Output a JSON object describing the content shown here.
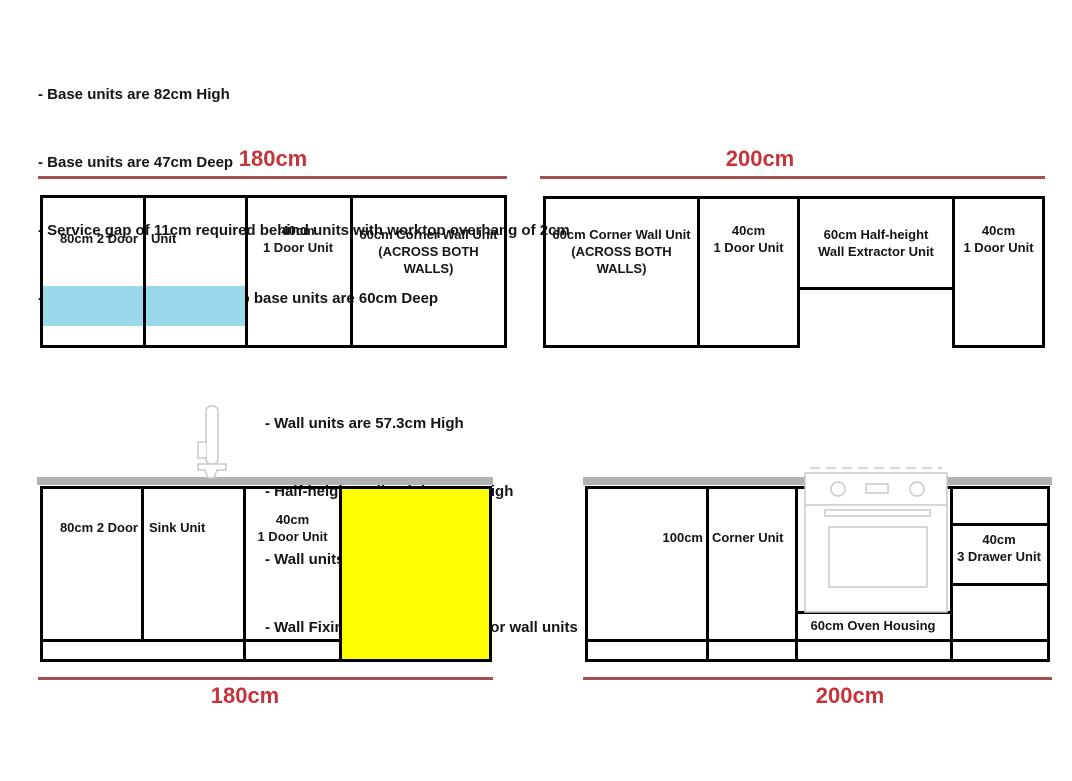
{
  "notes_base": {
    "lines": [
      "- Base units are 82cm High",
      "- Base units are 47cm Deep",
      "- Service gap of 11cm required behind units with worktop overhang of 2cm",
      "- When installed with worktop base units are 60cm Deep"
    ]
  },
  "notes_wall": {
    "lines": [
      "- Wall units are 57.3cm High",
      "- Half-height wall unit is 30cm High",
      "- Wall units are 30.5cm Deep",
      "- Wall Fixings are not included for wall units"
    ]
  },
  "wall_run_180": {
    "dimension": "180cm",
    "two_door_left": "80cm 2 Door",
    "two_door_right": "Unit",
    "one_door_l1": "40cm",
    "one_door_l2": "1 Door Unit",
    "corner_l1": "60cm Corner Wall Unit",
    "corner_l2": "(ACROSS BOTH",
    "corner_l3": "WALLS)"
  },
  "wall_run_200": {
    "dimension": "200cm",
    "corner_l1": "60cm Corner Wall Unit",
    "corner_l2": "(ACROSS BOTH",
    "corner_l3": "WALLS)",
    "one_door_a_l1": "40cm",
    "one_door_a_l2": "1 Door Unit",
    "extractor_l1": "60cm Half-height",
    "extractor_l2": "Wall Extractor Unit",
    "one_door_b_l1": "40cm",
    "one_door_b_l2": "1 Door Unit"
  },
  "base_run_180": {
    "dimension": "180cm",
    "two_door_left": "80cm 2 Door",
    "sink_label": "Sink Unit",
    "one_door_l1": "40cm",
    "one_door_l2": "1 Door Unit"
  },
  "base_run_200": {
    "dimension": "200cm",
    "corner_left": "100cm",
    "corner_right": "Corner Unit",
    "oven_housing": "60cm Oven Housing",
    "drawer_l1": "40cm",
    "drawer_l2": "3 Drawer Unit"
  },
  "icons": {
    "faucet": "faucet-icon",
    "oven": "oven-icon"
  },
  "colors": {
    "dimension_text": "#c5343a",
    "dimension_line": "#a35053",
    "highlight_blue": "#9ad9e9",
    "highlight_yellow": "#ffff00",
    "worktop_grey": "#b1b3b2",
    "line_black": "#000000",
    "appliance_outline": "#c9c9c9"
  }
}
